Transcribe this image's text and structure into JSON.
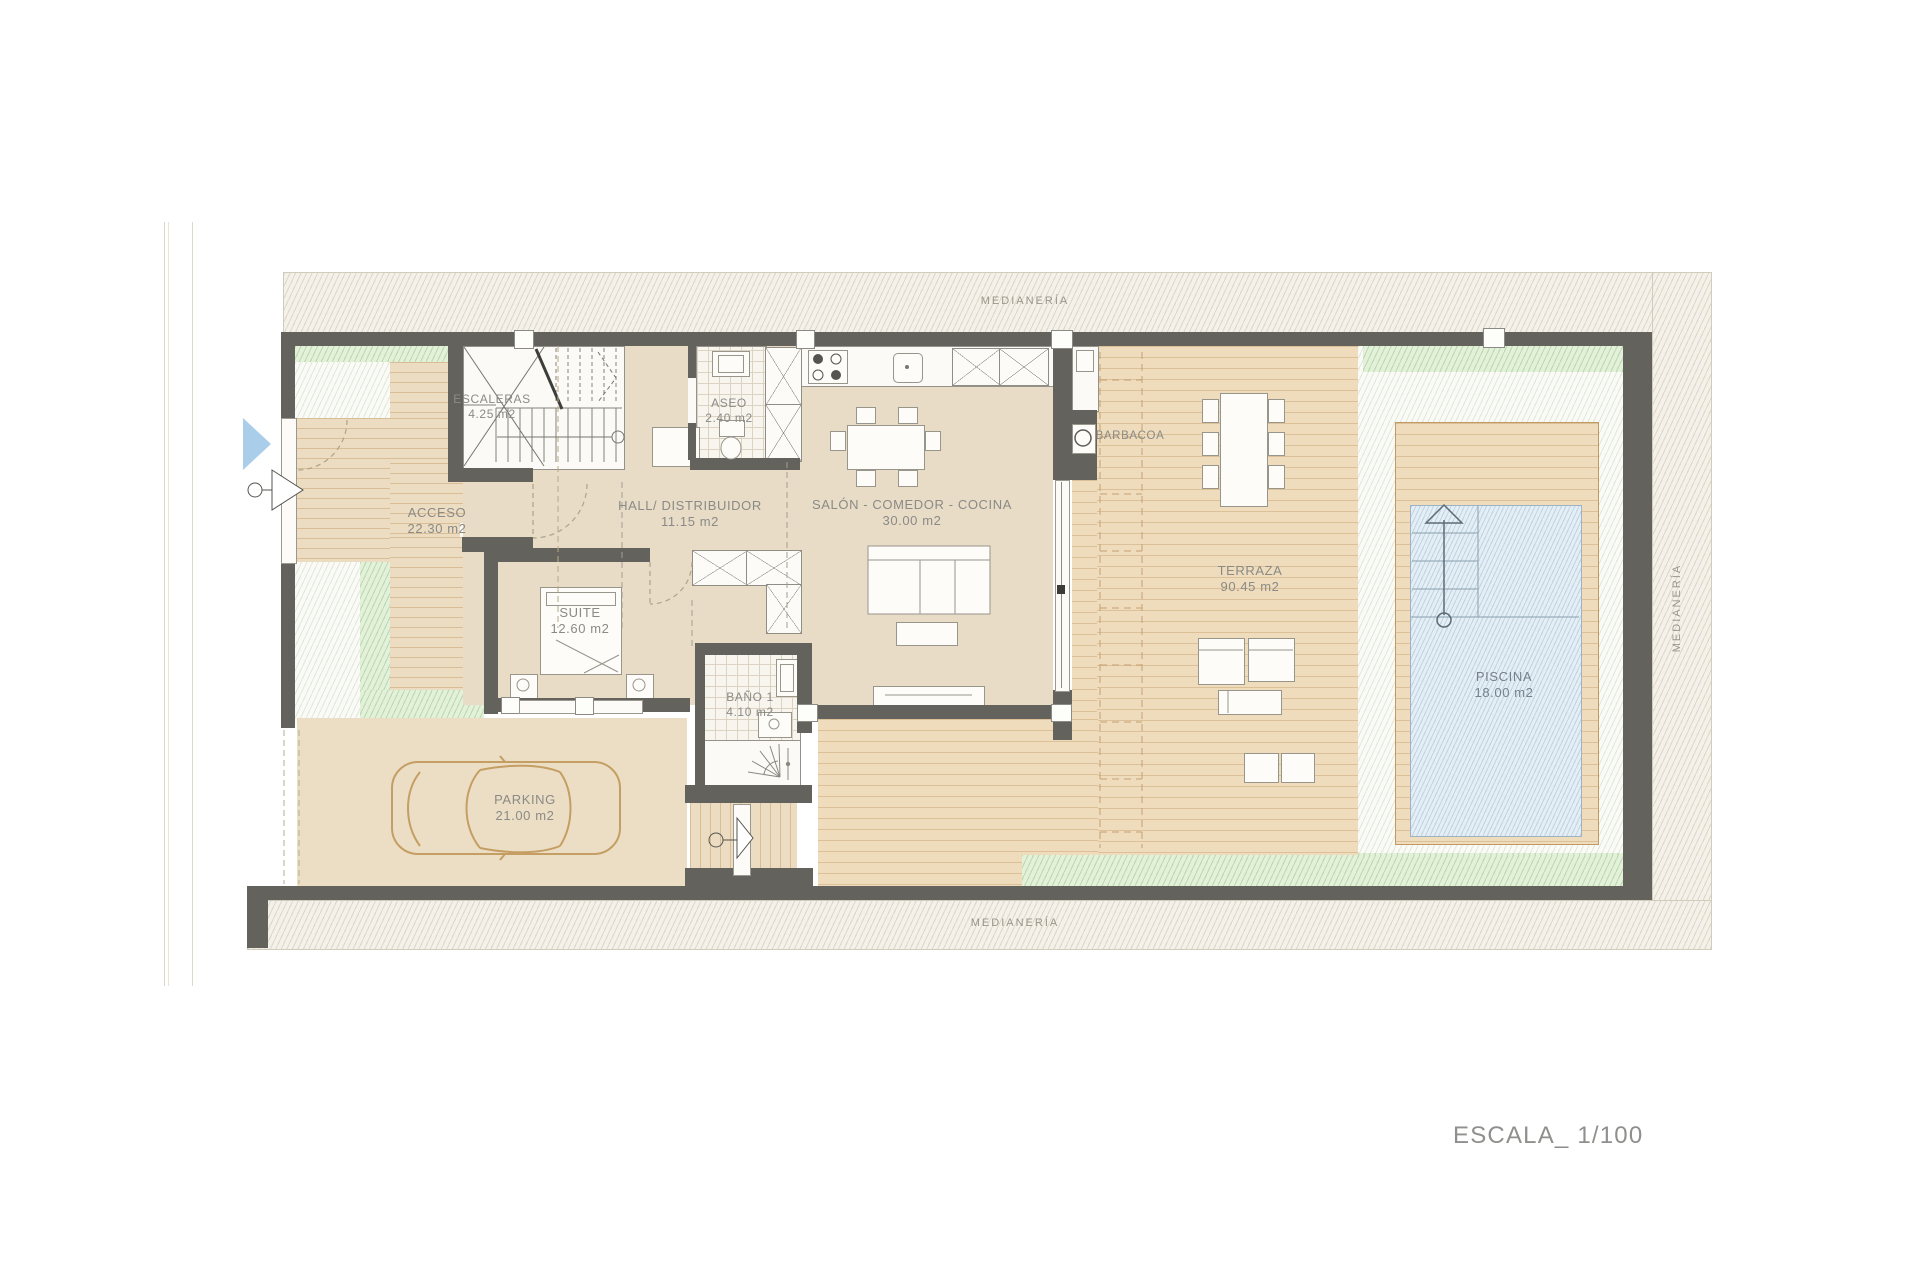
{
  "title": "Planta vivienda - plano arquitectónico",
  "scale": {
    "label": "ESCALA_ 1/100"
  },
  "boundaries": {
    "top": "MEDIANERÍA",
    "bottom": "MEDIANERÍA",
    "right": "MEDIANERÍA"
  },
  "rooms": {
    "escaleras": {
      "name": "ESCALERAS",
      "area": "4.25 m2"
    },
    "aseo": {
      "name": "ASEO",
      "area": "2.40 m2"
    },
    "hall": {
      "name": "HALL/ DISTRIBUIDOR",
      "area": "11.15 m2"
    },
    "salon": {
      "name": "SALÓN - COMEDOR - COCINA",
      "area": "30.00 m2"
    },
    "acceso": {
      "name": "ACCESO",
      "area": "22.30 m2"
    },
    "suite": {
      "name": "SUITE",
      "area": "12.60 m2"
    },
    "bano": {
      "name": "BAÑO 1",
      "area": "4.10 m2"
    },
    "barbacoa": {
      "name": "BARBACOA"
    },
    "terraza": {
      "name": "TERRAZA",
      "area": "90.45 m2"
    },
    "piscina": {
      "name": "PISCINA",
      "area": "18.00 m2"
    },
    "parking": {
      "name": "PARKING",
      "area": "21.00 m2"
    }
  },
  "colors": {
    "wall": "#64625d",
    "interior_floor": "#e8dcc7",
    "deck": "#eedcbc",
    "green_garden": "#e3f0da",
    "pool_water": "#e4eef5",
    "entry_arrow": "#aacdea",
    "label_text": "#8a8a86"
  }
}
